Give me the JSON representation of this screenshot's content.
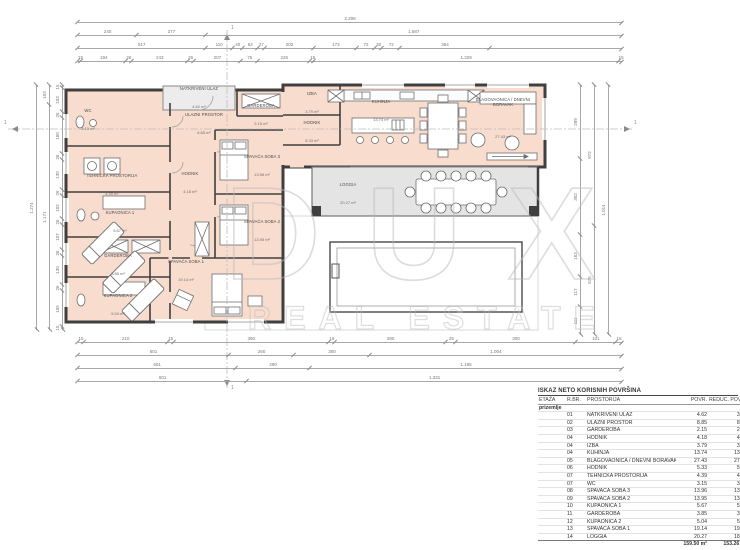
{
  "drawing": {
    "watermark": {
      "line1": "DUX",
      "line2": "REAL ESTATE"
    },
    "section_markers": {
      "h_left": "1",
      "h_right": "1",
      "v_top": "1",
      "v_bottom": "1"
    },
    "rooms": [
      {
        "name": "NATKRIVENI ULAZ",
        "area": "4.62 m²"
      },
      {
        "name": "ULAZNI PROSTOR",
        "area": "8.85 m²"
      },
      {
        "name": "GARDEROBA",
        "area": "2.15 m²"
      },
      {
        "name": "WC",
        "area": "3.15 m²"
      },
      {
        "name": "TEHNIČKA PROSTORIJA",
        "area": "4.39 m²"
      },
      {
        "name": "KUPAONICA 1",
        "area": "5.67 m²"
      },
      {
        "name": "GARDEROBA",
        "area": "3.85 m²"
      },
      {
        "name": "KUPAONICA 2",
        "area": "5.04 m²"
      },
      {
        "name": "HODNIK",
        "area": "4.18 m²"
      },
      {
        "name": "SPAVAĆA SOBA 3",
        "area": "13.96 m²"
      },
      {
        "name": "SPAVAĆA SOBA 2",
        "area": "13.95 m²"
      },
      {
        "name": "SPAVAĆA SOBA 1",
        "area": "19.14 m²"
      },
      {
        "name": "IZBA",
        "area": "3.79 m²"
      },
      {
        "name": "HODNIK",
        "area": "5.33 m²"
      },
      {
        "name": "KUHINJA",
        "area": "13.74 m²"
      },
      {
        "name": "BLAGOVAONICA / DNEVNI BORAVAK",
        "area": "27.43 m²"
      },
      {
        "name": "LOGGIA",
        "area": "20.27 m²"
      }
    ],
    "dims": {
      "top": [
        {
          "segments": [
            "2.298"
          ]
        },
        {
          "segments": [
            "240",
            "277",
            "1.687"
          ]
        },
        {
          "segments": [
            "517",
            "110",
            "40",
            "62",
            "27",
            "202",
            "173",
            "72",
            "30",
            "72",
            "364",
            {
              "label": "",
              "w": 535
            }
          ]
        },
        {
          "segments": [
            "15",
            "194",
            "26",
            "243",
            "26",
            "207",
            "75",
            "226",
            "15",
            "1.329",
            "15"
          ]
        }
      ],
      "bottom": [
        {
          "segments": [
            "15",
            "210",
            "15",
            "390",
            "15",
            "280",
            "25",
            "300",
            "101",
            "15"
          ]
        },
        {
          "segments": [
            "601",
            "260",
            "300",
            "1.004"
          ]
        },
        {
          "segments": [
            "601",
            "280",
            "1.185"
          ]
        },
        {
          "segments": [
            "601",
            "1.331"
          ]
        }
      ],
      "left": [
        {
          "segments": [
            "1.274"
          ]
        },
        {
          "segments": [
            "103",
            "1.171"
          ]
        },
        {
          "segments": [
            "15",
            "103",
            "26",
            "160",
            "26",
            "130",
            "26",
            "102",
            "26",
            "107",
            "26",
            "130",
            "26",
            "155",
            "15"
          ]
        }
      ],
      "right": [
        {
          "segments": [
            "289",
            "302",
            "163",
            "117",
            "111"
          ]
        },
        {
          "segments": [
            "872",
            "675"
          ]
        },
        {
          "segments": [
            "1.014"
          ]
        }
      ]
    }
  },
  "table": {
    "title": "ISKAZ NETO KORISNIH POVRŠINA",
    "headers": {
      "etaza": "ETAŽA",
      "rbr": "R.BR.",
      "prostorija": "PROSTORIJA",
      "povr": "POVR.",
      "reduc": "REDUC. POVRŠINA"
    },
    "floor_label": "prizemlje",
    "rows": [
      {
        "no": "01",
        "name": "NATKRIVENI ULAZ",
        "povr": "4.62",
        "reduc": "3.46"
      },
      {
        "no": "02",
        "name": "ULAZNI PROSTOR",
        "povr": "8.85",
        "reduc": "8.85"
      },
      {
        "no": "03",
        "name": "GARDEROBA",
        "povr": "2.15",
        "reduc": "2.15"
      },
      {
        "no": "04",
        "name": "HODNIK",
        "povr": "4.18",
        "reduc": "4.18"
      },
      {
        "no": "04",
        "name": "IZBA",
        "povr": "3.79",
        "reduc": "3.79"
      },
      {
        "no": "04",
        "name": "KUHINJA",
        "povr": "13.74",
        "reduc": "13.74"
      },
      {
        "no": "05",
        "name": "BLAGOVAONICA / DNEVNI BORAVAK",
        "povr": "27.43",
        "reduc": "27.43"
      },
      {
        "no": "06",
        "name": "HODNIK",
        "povr": "5.33",
        "reduc": "5.33"
      },
      {
        "no": "07",
        "name": "TEHNIČKA PROSTORIJA",
        "povr": "4.39",
        "reduc": "4.39"
      },
      {
        "no": "07",
        "name": "WC",
        "povr": "3.15",
        "reduc": "3.15"
      },
      {
        "no": "08",
        "name": "SPAVAĆA SOBA 3",
        "povr": "13.96",
        "reduc": "13.96"
      },
      {
        "no": "09",
        "name": "SPAVAĆA SOBA 2",
        "povr": "13.95",
        "reduc": "13.95"
      },
      {
        "no": "10",
        "name": "KUPAONICA 1",
        "povr": "5.67",
        "reduc": "5.67"
      },
      {
        "no": "11",
        "name": "GARDEROBA",
        "povr": "3.85",
        "reduc": "3.85"
      },
      {
        "no": "12",
        "name": "KUPAONICA 2",
        "povr": "5.04",
        "reduc": "5.04"
      },
      {
        "no": "13",
        "name": "SPAVAĆA SOBA 1",
        "povr": "19.14",
        "reduc": "19.14"
      },
      {
        "no": "14",
        "name": "LOGGIA",
        "povr": "20.27",
        "reduc": "18.21"
      }
    ],
    "totals": {
      "povr": "159.50 m²",
      "reduc": "153.26 m²"
    }
  }
}
